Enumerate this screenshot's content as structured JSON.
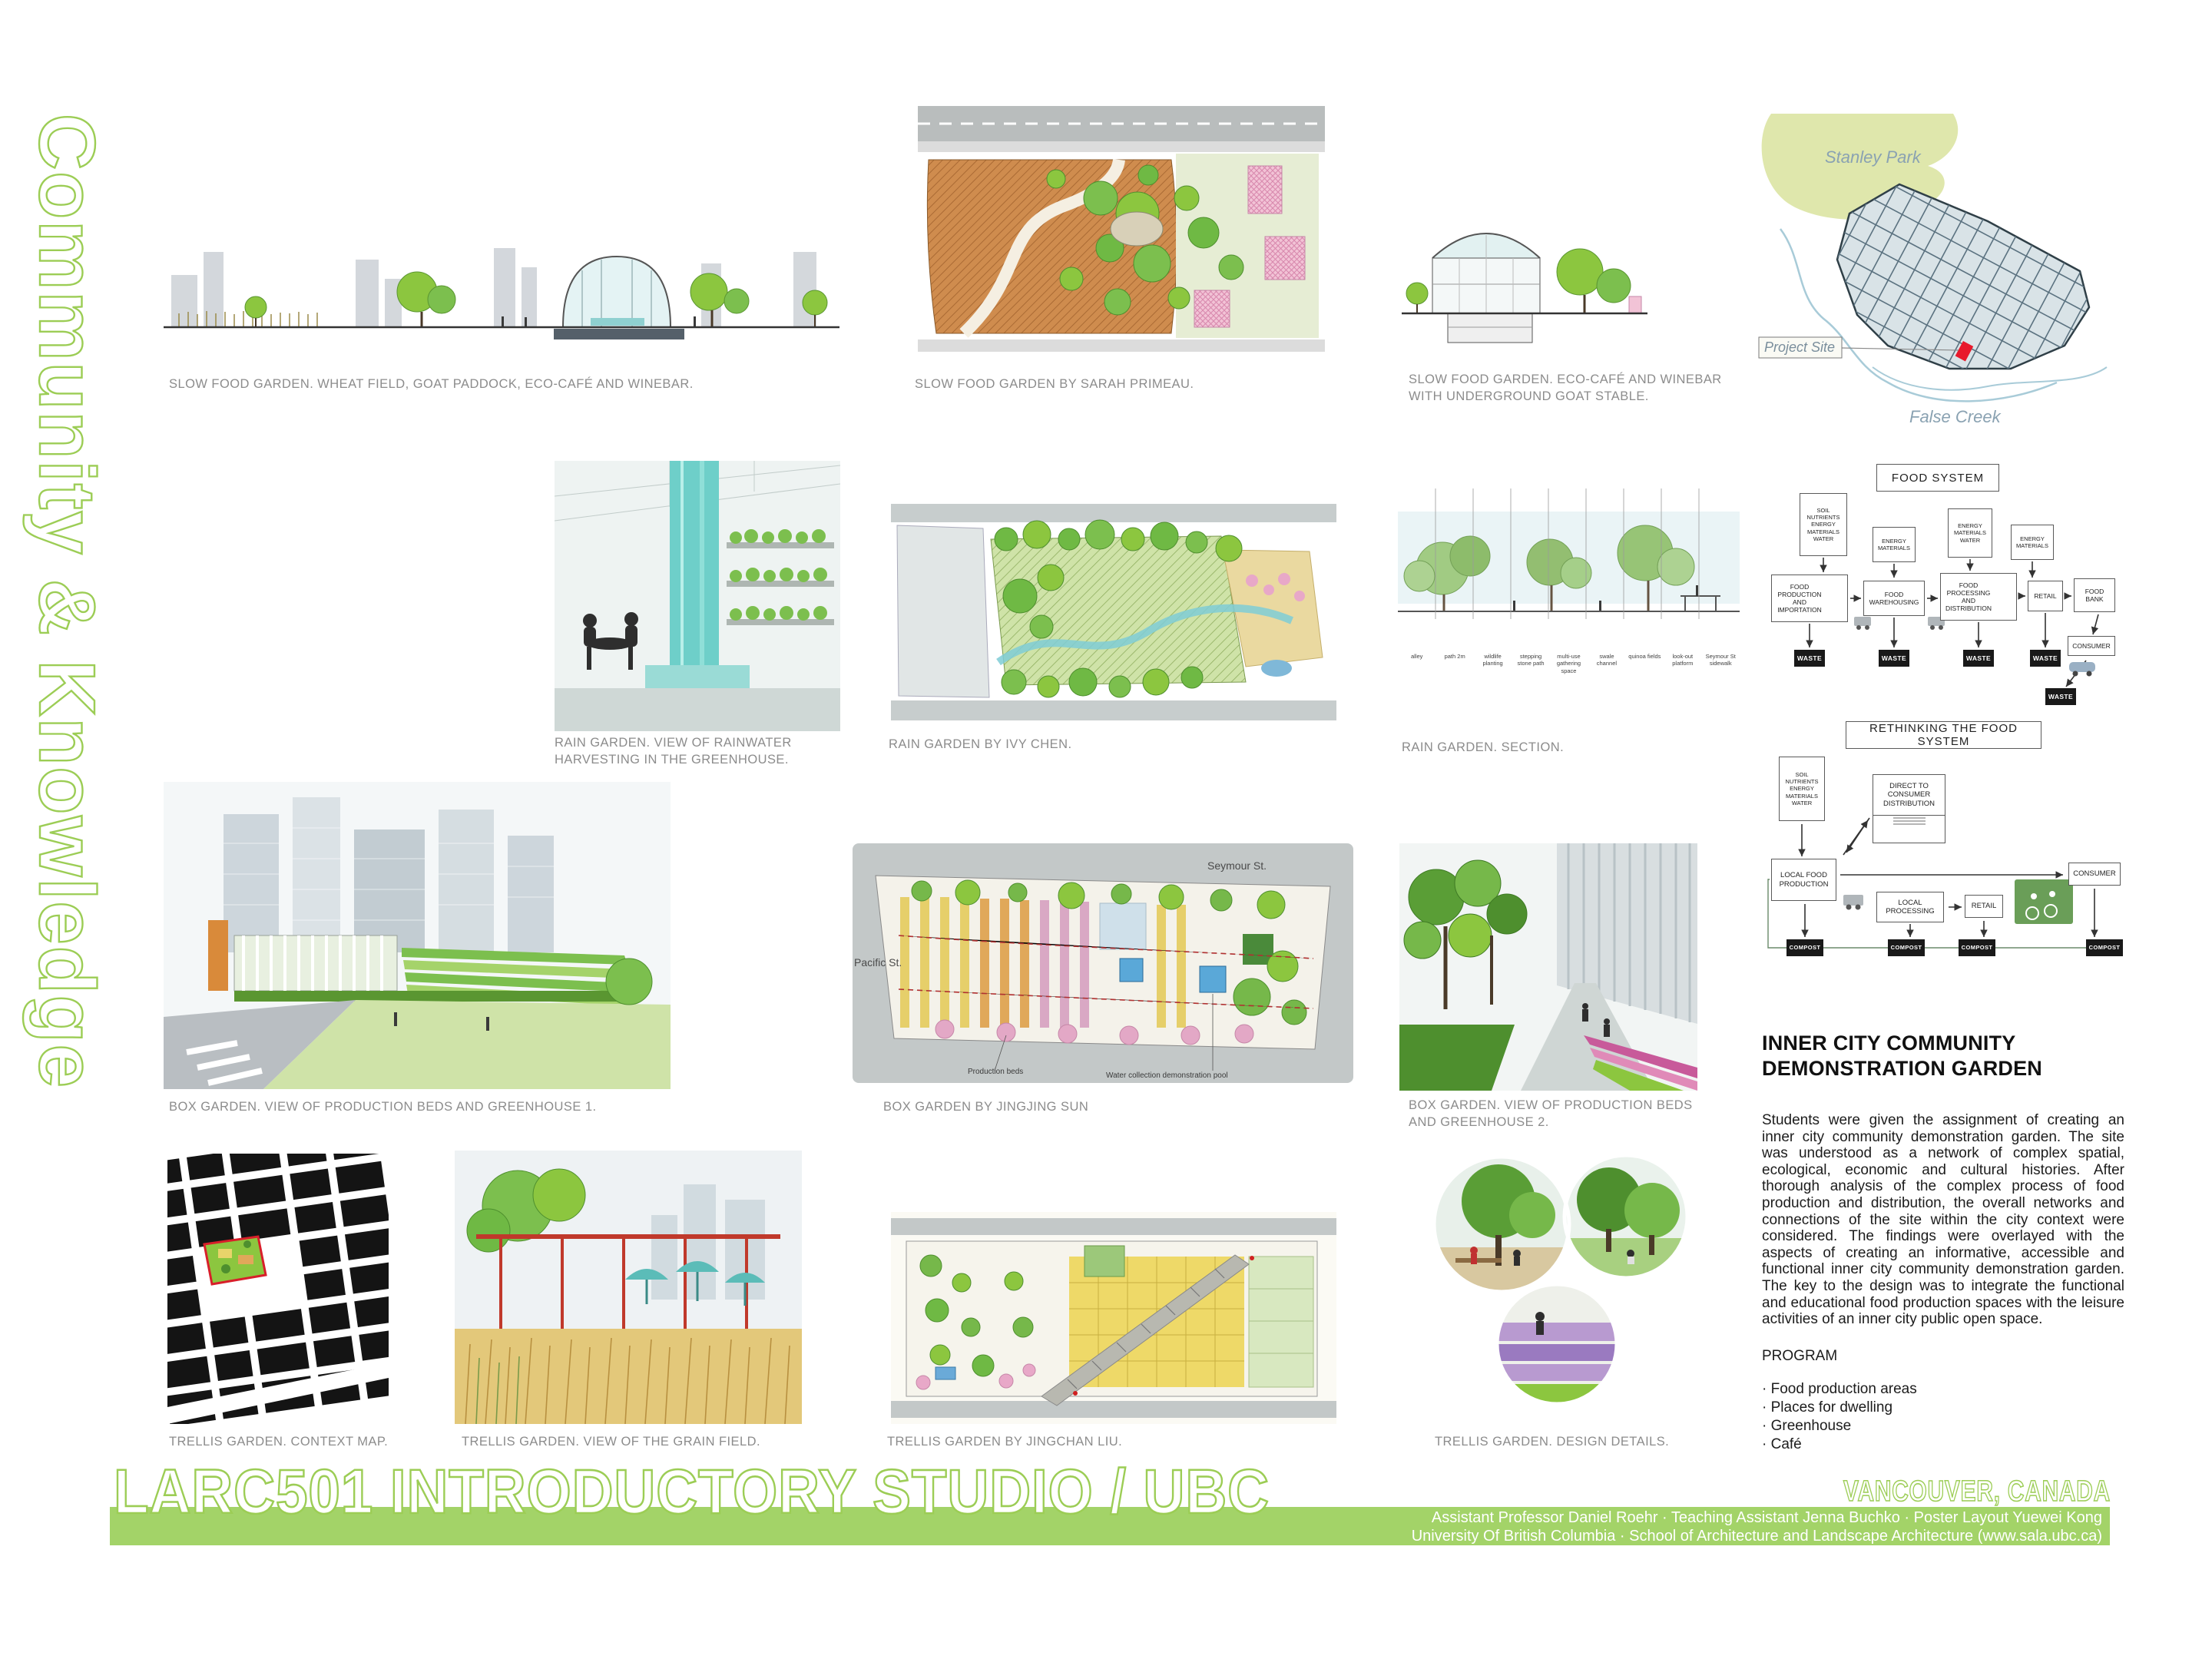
{
  "poster": {
    "vertical_title": "Community & Knowledge",
    "main_title": "LARC501 INTRODUCTORY STUDIO / UBC",
    "location": "VANCOUVER, CANADA",
    "credits_line1": "Assistant Professor Daniel Roehr · Teaching Assistant Jenna Buchko · Poster Layout Yuewei Kong",
    "credits_line2": "University Of British Columbia · School of Architecture and Landscape Architecture (www.sala.ubc.ca)",
    "colors": {
      "green_outline": "#9ccd55",
      "bar_green": "#a3d368",
      "park_green": "#dfe7ac",
      "site_red": "#e8192c",
      "caption_gray": "#8c8c8c"
    }
  },
  "captions": {
    "slow_food_1": "SLOW FOOD GARDEN. WHEAT FIELD, GOAT PADDOCK, ECO-CAFÉ AND WINEBAR.",
    "slow_food_2": "SLOW FOOD GARDEN BY SARAH PRIMEAU.",
    "slow_food_3": "SLOW FOOD GARDEN. ECO-CAFÉ AND WINEBAR WITH UNDERGROUND GOAT STABLE.",
    "rain_1": "RAIN GARDEN. VIEW OF RAINWATER HARVESTING IN THE GREENHOUSE.",
    "rain_2": "RAIN GARDEN BY IVY CHEN.",
    "rain_3": "RAIN GARDEN. SECTION.",
    "box_1": "BOX GARDEN. VIEW OF PRODUCTION BEDS AND GREENHOUSE 1.",
    "box_2": "BOX GARDEN BY JINGJING SUN",
    "box_3": "BOX GARDEN. VIEW OF PRODUCTION BEDS AND GREENHOUSE 2.",
    "trellis_1": "TRELLIS GARDEN. CONTEXT MAP.",
    "trellis_2": "TRELLIS GARDEN. VIEW OF THE GRAIN FIELD.",
    "trellis_3": "TRELLIS GARDEN BY JINGCHAN LIU.",
    "trellis_4": "TRELLIS GARDEN. DESIGN DETAILS."
  },
  "map": {
    "park_label": "Stanley Park",
    "site_label": "Project Site",
    "water_label": "False Creek"
  },
  "food_system": {
    "title": "FOOD SYSTEM",
    "inputs": [
      "SOIL NUTRIENTS ENERGY MATERIALS WATER",
      "ENERGY MATERIALS",
      "ENERGY MATERIALS WATER",
      "ENERGY MATERIALS"
    ],
    "stages": [
      "FOOD PRODUCTION AND IMPORTATION",
      "FOOD WAREHOUSING",
      "FOOD PROCESSING AND DISTRIBUTION",
      "RETAIL",
      "FOOD BANK"
    ],
    "waste": "WASTE",
    "consumer": "CONSUMER"
  },
  "rethinking": {
    "title": "RETHINKING THE FOOD SYSTEM",
    "input": "SOIL NUTRIENTS ENERGY MATERIALS WATER",
    "direct_to_consumer": "DIRECT TO CONSUMER DISTRIBUTION",
    "local_food_production": "LOCAL FOOD PRODUCTION",
    "local_processing": "LOCAL PROCESSING",
    "retail": "RETAIL",
    "consumer": "CONSUMER",
    "compost": "COMPOST"
  },
  "rain_section": {
    "labels": [
      "alley",
      "path 2m",
      "wildlife planting",
      "stepping stone path",
      "multi-use gathering space",
      "swale channel",
      "quinoa fields",
      "look-out platform",
      "Seymour St sidewalk"
    ]
  },
  "box_plan": {
    "street_top": "Seymour St.",
    "street_left": "Pacific St.",
    "label_beds": "Production beds",
    "label_pool": "Water collection demonstration pool",
    "annotations": [
      "Sitting Area",
      "Water collector",
      "Compost box",
      "Green hedge 2.5m",
      "Contour line",
      "Clover field",
      "Green house",
      "Wooden house (Café)"
    ]
  },
  "article": {
    "heading_line1": "INNER CITY COMMUNITY",
    "heading_line2": "DEMONSTRATION GARDEN",
    "body": "Students were given the assignment of creating an inner city community demonstration garden. The site was understood as a network of complex spatial, ecological, economic and cultural histories. After thorough analysis of the complex process of food production and distribution, the overall networks and connections of the site within the city context were considered. The findings were overlayed with the aspects of creating an informative, accessible and functional inner city community demonstration garden. The key to the design was to integrate the functional and educational food production spaces with the leisure activities of an inner city public open space.",
    "program_heading": "PROGRAM",
    "program_items": [
      "Food production areas",
      "Places for dwelling",
      "Greenhouse",
      "Café"
    ]
  }
}
